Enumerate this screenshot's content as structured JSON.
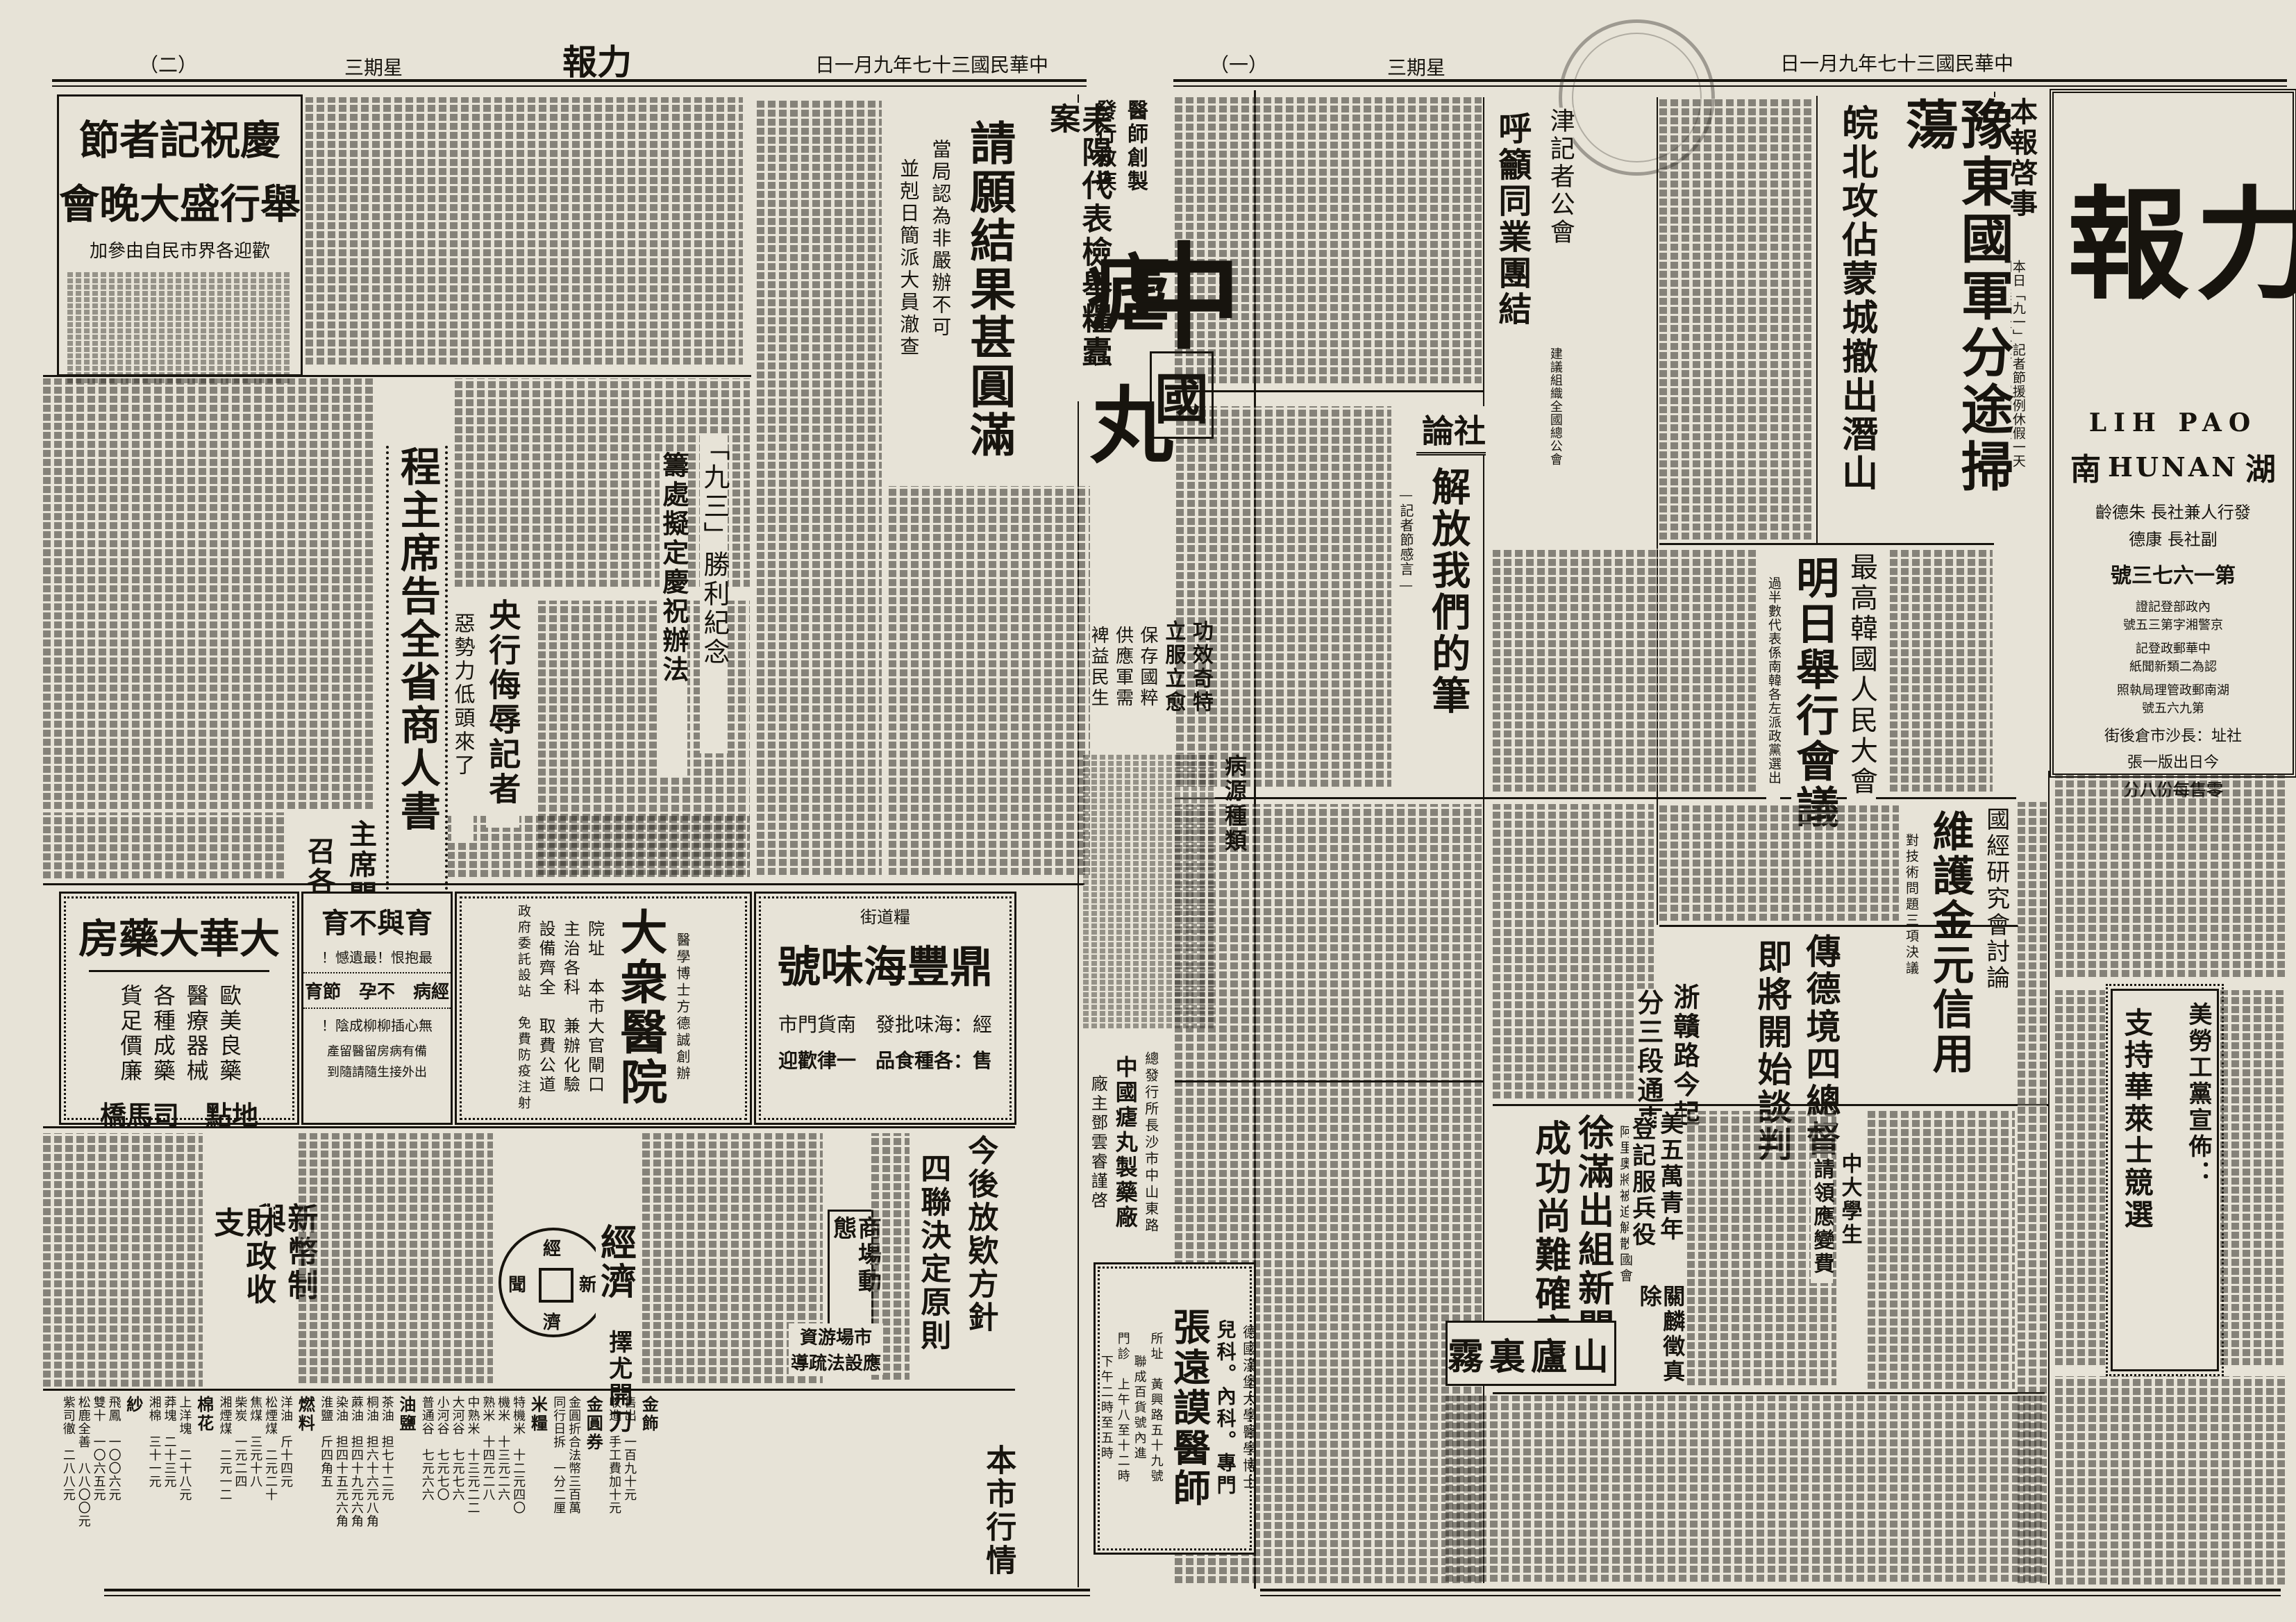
{
  "sheet": {
    "page1_header": {
      "date": "中華民國三十七年九月一日",
      "weekday": "星期三",
      "page_no": "（一）"
    },
    "page2_header": {
      "date": "中華民國三十七年九月一日",
      "title": "力報",
      "weekday": "星期三",
      "page_no": "（二）"
    }
  },
  "masthead": {
    "title": "力報",
    "latin": "LIH PAO",
    "region_left": "南",
    "region_latin": "HUNAN",
    "region_right": "湖",
    "publisher1": "發行人兼社長 朱德齡",
    "publisher2": "副社長 康德",
    "issue": "第一六七三號",
    "reg1": "內政部登記證",
    "reg2": "京警湘字第三五號",
    "postal1": "中華郵政登記",
    "postal2": "認為二類新聞紙",
    "license1": "湖南郵政管理局執照",
    "license2": "第九六五號",
    "address": "社址：長沙市倉後街",
    "edition": "今日出版一張",
    "price": "零售每份八分"
  },
  "page1": {
    "notice": {
      "title": "本報啓事",
      "line1": "本日「九一」記者節援例休假一天",
      "line2": "明日無報後（三）日照常出版"
    },
    "lead": {
      "main": "豫東國軍分途掃蕩",
      "sub": "皖北攻佔蒙城撤出潛山"
    },
    "tianjin": {
      "kicker": "津記者公會",
      "main": "呼籲同業團結",
      "sub": "建議組織全國總公會"
    },
    "editorial": {
      "label": "社論",
      "title": "解放我們的筆",
      "byline": "—記者節感言—"
    },
    "korea": {
      "kicker": "最高韓國人民大會",
      "main": "明日舉行會議",
      "sub": "過半數代表係南韓各左派政黨選出"
    },
    "gold": {
      "kicker": "國經研究會討論",
      "main": "維護金元信用",
      "sub": "對技術問題三項決議"
    },
    "germany": {
      "line1": "傳德境四總督",
      "line2": "即將開始談判"
    },
    "zhegan": {
      "line1": "浙贛路今起",
      "line2": "分三段通車"
    },
    "schuman": {
      "line1": "徐滿出組新閣",
      "line2": "成功尚難確定",
      "sub": "阿里奧將被迫解散國會"
    },
    "us_youth": {
      "line1": "美五萬青年",
      "line2": "登記服兵役"
    },
    "guan": {
      "title": "關麟徵真除"
    },
    "students": {
      "line1": "中大學生",
      "line2": "請領應變費"
    },
    "labor": {
      "line1": "美勞工黨宣佈：",
      "line2": "支持華萊士競選"
    },
    "lushan": {
      "title": "霧裏廬山"
    }
  },
  "page2": {
    "leiyang": {
      "kicker": "耒陽代表檢舉糧蠹案",
      "main": "請願結果甚圓滿",
      "sub1": "當局認為非嚴辦不可",
      "sub2": "並剋日簡派大員澈查"
    },
    "celebration": {
      "line1": "慶祝記者節",
      "line2": "舉行盛大晚會",
      "line3": "歡迎各界市民自由參加"
    },
    "governor": {
      "title": "程主席告全省商人書"
    },
    "sep3": {
      "line1": "「九三」勝利紀念",
      "line2": "籌處擬定慶祝辦法"
    },
    "bank": {
      "main": "央行侮辱記者",
      "sub": "惡勢力低頭來了"
    },
    "prices": {
      "line1": "主席關切物價波動",
      "line2": "召各首長共商善策"
    },
    "loans": {
      "line1": "今後放欵方針",
      "line2": "四聯決定原則"
    },
    "biz": {
      "title": "商場動態"
    },
    "funds": {
      "line1": "市場游資",
      "line2": "應設法疏導"
    },
    "surgery": {
      "title": "擇尤開刀"
    },
    "currency": {
      "line1": "新幣制與",
      "line2": "財政收支"
    },
    "economy": {
      "label": "經濟",
      "coin_t": "經",
      "coin_b": "濟",
      "coin_r": "新",
      "coin_l": "聞"
    },
    "market_title": "本市行情",
    "market": [
      {
        "cat": "金飾",
        "items": [
          "售出　一百九十元",
          "收進　手工費加十元"
        ]
      },
      {
        "cat": "金圓券",
        "items": [
          "金圓折合法幣三百萬",
          "同行日拆　一分二厘"
        ]
      },
      {
        "cat": "米糧",
        "items": [
          "特機米　十二元四〇",
          "機米　十三元二六",
          "熟米　十四元二八",
          "中熟米　十三元二二",
          "大河谷　七元七六",
          "小河谷　七元七〇",
          "普通谷　七元六六"
        ]
      },
      {
        "cat": "油鹽",
        "items": [
          "茶油　担七十二元",
          "桐油　担六十六元八角",
          "蔴油　担四十九元六角",
          "染油　担四十五元六角",
          "淮鹽　斤四角五"
        ]
      },
      {
        "cat": "燃料",
        "items": [
          "洋油　斤十四元",
          "松煙煤　二元二十",
          "焦煤　三元十八",
          "柴炭　一元二四",
          "湘煙煤　二元一二"
        ]
      },
      {
        "cat": "棉花",
        "items": [
          "上洋塊　二十八元",
          "莽塊　二十三元",
          "湘棉　三十一元"
        ]
      },
      {
        "cat": "紗",
        "items": [
          "飛鳳　一〇〇六元",
          "雙十　一〇六五元",
          "松鹿全善　八八〇〇元",
          "紫司徹　二八八元"
        ]
      }
    ]
  },
  "ads": {
    "dahua": {
      "name": "大華大藥房",
      "item0": "歐美良藥",
      "item1": "醫療器械",
      "item2": "各種成藥",
      "item3": "貨足價廉",
      "footer": "地點　司馬橋"
    },
    "fertility": {
      "title": "育與不育",
      "l0": "最抱恨！最遺憾！",
      "l1": "經病　不孕　節育",
      "l2": "無心插柳柳成陰！",
      "l3": "備有病房留醫留產",
      "l4": "出外接生隨請隨到"
    },
    "dazhong": {
      "founder": "醫學博士方德誠創辦",
      "name": "大衆醫院",
      "addr": "院址　本市大官閘口",
      "l1": "主治各科　兼辦化驗",
      "l2": "設備齊全　取費公道",
      "l3": "政府委託設站　免費防疫注射"
    },
    "dingfeng": {
      "name": "鼎豐海味號",
      "street": "糧道街",
      "l1": "經：海味批發　南貨門市",
      "l2": "售：各種食品　一律歡迎"
    },
    "malaria": {
      "maker1": "醫師創製",
      "maker2": "發行救疾",
      "c1": "中",
      "c2": "國",
      "c3": "瘧",
      "c4": "丸",
      "s0": "功效奇特",
      "s1": "立服立愈",
      "s2": "保存國粹",
      "s3": "供應軍需",
      "s4": "裨益民生",
      "section": "病源種類",
      "dist": "總發行所長沙市中山東路",
      "factory": "中國瘧丸製藥廠",
      "owner": "廠主鄧雲睿謹啓"
    },
    "zhang": {
      "degree": "德國漢堡大學醫學博士",
      "dept": "兒科。內科。專門",
      "name": "張遠謨醫師",
      "addr1": "所址　黃興路五十九號",
      "addr2": "聯成百貨號內進",
      "hours1": "門診　上午八至十二時",
      "hours2": "下午二時至五時"
    }
  }
}
